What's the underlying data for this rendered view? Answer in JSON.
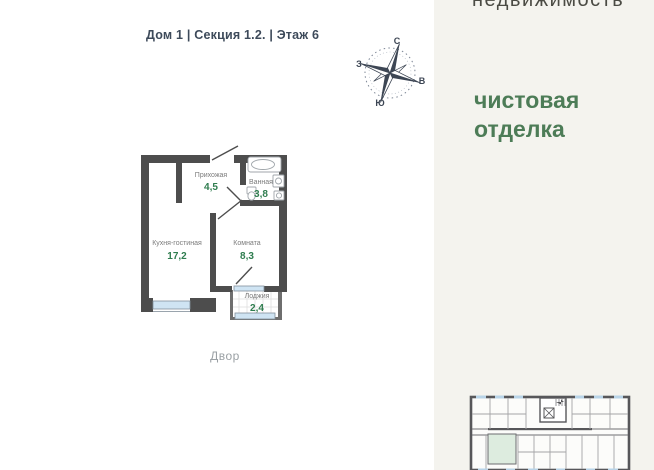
{
  "header": {
    "location_label": "Дом 1 | Секция 1.2. | Этаж 6"
  },
  "compass": {
    "north": "С",
    "east": "В",
    "south": "Ю",
    "west": "З"
  },
  "plan": {
    "rooms": [
      {
        "name": "Прихожая",
        "area": "4,5"
      },
      {
        "name": "Ванная",
        "area": "3,8"
      },
      {
        "name": "Кухня-гостиная",
        "area": "17,2"
      },
      {
        "name": "Комната",
        "area": "8,3"
      },
      {
        "name": "Лоджия",
        "area": "2,4"
      }
    ],
    "courtyard_label": "Двор"
  },
  "sidebar": {
    "brand_text": "недвижимость",
    "finish_text": "чистовая отделка"
  },
  "colors": {
    "accent_green": "#4d7c57",
    "area_green": "#2f7d4f",
    "wall_dark": "#4d4d4d",
    "window_blue": "#cfe4f3",
    "panel_background": "#f4f3ee",
    "highlighted_unit": "#ddecdf",
    "title_dark": "#3d4a5a"
  }
}
